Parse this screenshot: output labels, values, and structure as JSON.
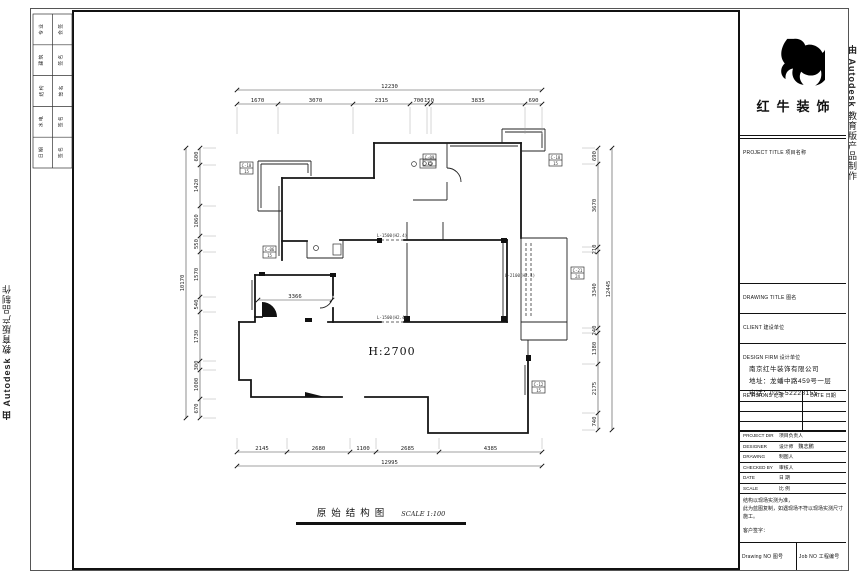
{
  "stamps": {
    "autodesk_bold": "由 Autodesk",
    "autodesk_rest": " 教育版产品制作"
  },
  "sign_strip": {
    "rows": [
      {
        "a": "专 业",
        "b": "会 签"
      },
      {
        "a": "建 筑",
        "b": "签 名"
      },
      {
        "a": "结 构",
        "b": "签 名"
      },
      {
        "a": "水 电",
        "b": "签 名"
      },
      {
        "a": "日 期",
        "b": "签 名"
      }
    ]
  },
  "plan": {
    "height_label": "H:2700",
    "dim_chains": [
      {
        "id": "top",
        "orient": "h",
        "line": 104,
        "overall_line": 90,
        "ext_len": 30,
        "ext": 1,
        "bounds": [
          237,
          278,
          353,
          410,
          427,
          431,
          525,
          542
        ],
        "labels": [
          "1670",
          "3070",
          "2315",
          "700",
          "150",
          "3835",
          "690"
        ],
        "overall": "12230"
      },
      {
        "id": "bottom",
        "orient": "h",
        "line": 452,
        "overall_line": 466,
        "ext_len": 14,
        "ext": -1,
        "bounds": [
          237,
          287,
          350,
          376,
          439,
          542
        ],
        "labels": [
          "2145",
          "2680",
          "1100",
          "2685",
          "4385"
        ],
        "overall": "12995"
      },
      {
        "id": "left",
        "orient": "v",
        "line": 200,
        "overall_line": 186,
        "ext_len": 16,
        "ext": 1,
        "bounds": [
          148,
          165,
          206,
          236,
          252,
          297,
          312,
          361,
          370,
          399,
          418
        ],
        "labels": [
          "600",
          "1420",
          "1060",
          "550",
          "1570",
          "540",
          "1730",
          "300",
          "1000",
          "670"
        ],
        "overall": "10170"
      },
      {
        "id": "right",
        "orient": "v",
        "line": 598,
        "overall_line": 612,
        "ext_len": 16,
        "ext": -1,
        "bounds": [
          148,
          164,
          247,
          252,
          328,
          333,
          364,
          413,
          430
        ],
        "labels": [
          "690",
          "3670",
          "210",
          "3340",
          "240",
          "1380",
          "2175",
          "740"
        ],
        "overall": "12445"
      }
    ],
    "interior_dim": {
      "label": "3366",
      "x1": 258,
      "x2": 332,
      "y": 300
    },
    "opening_labels": [
      {
        "text": "L-1500(H2.4)",
        "x": 392,
        "y": 237
      },
      {
        "text": "L-1500(H2.4)",
        "x": 392,
        "y": 319
      },
      {
        "text": "L-2100(H2.4)",
        "x": 520,
        "y": 277
      }
    ],
    "window_tags": [
      {
        "x": 240,
        "y": 162,
        "l1": "C-18",
        "l2": "15"
      },
      {
        "x": 423,
        "y": 154,
        "l1": "C-09",
        "l2": "15"
      },
      {
        "x": 549,
        "y": 154,
        "l1": "C-18",
        "l2": "15"
      },
      {
        "x": 571,
        "y": 267,
        "l1": "C-21",
        "l2": "24"
      },
      {
        "x": 532,
        "y": 381,
        "l1": "C-12",
        "l2": "15"
      },
      {
        "x": 263,
        "y": 246,
        "l1": "C-06",
        "l2": "15"
      }
    ]
  },
  "footer": {
    "title": "原始结构图",
    "scale": "SCALE 1:100"
  },
  "title_block": {
    "brand_name": "红牛装饰",
    "project_title_label": "PROJECT TITLE 项目名称",
    "drawing_title_label": "DRAWING TITLE 图名",
    "client_label": "CLIENT 建设单位",
    "design_firm_label": "DESIGN FIRM 设计单位",
    "company": "南京红牛装饰有限公司",
    "address": "地址：龙蟠中路459号一层",
    "phone": "电话：025-52228155",
    "revisions_label": "REVISIONS 记录",
    "date_col_label": "DATE 日期",
    "rows": [
      {
        "en": "PROJECT DIR",
        "cn": "项目负责人",
        "value": ""
      },
      {
        "en": "DESIGNER",
        "cn": "设计师",
        "value": "魏志鹏"
      },
      {
        "en": "DRAWING",
        "cn": "制图人",
        "value": ""
      },
      {
        "en": "CHECKED BY",
        "cn": "审核人",
        "value": ""
      },
      {
        "en": "DATE",
        "cn": "日 期",
        "value": ""
      },
      {
        "en": "SCALE",
        "cn": "比 例",
        "value": ""
      }
    ],
    "note_lines": [
      "结构以现场实测为准，",
      "此为蓝图复制，如遇现场不符以现场实测尺寸施工。"
    ],
    "sign_label": "客户签字：",
    "drawing_no_label": "Drawing NO 图号",
    "job_no_label": "Job NO 工程编号"
  }
}
